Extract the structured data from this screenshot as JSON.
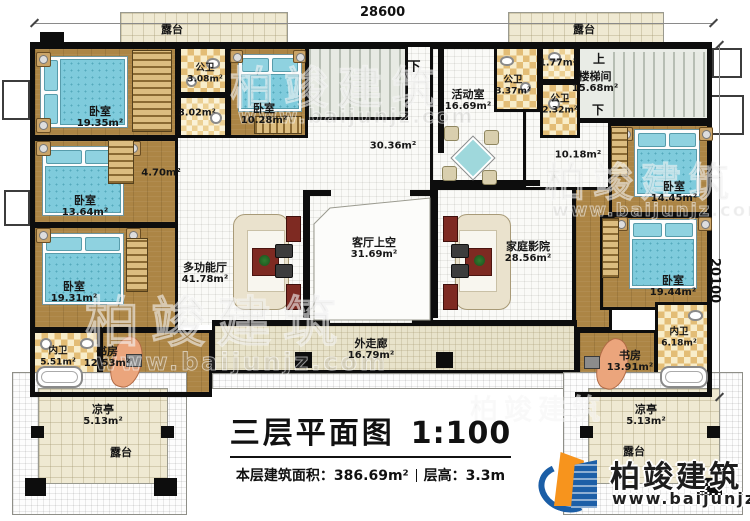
{
  "dimensions": {
    "top": "28600",
    "right": "20100"
  },
  "titleblock": {
    "title": "三层平面图",
    "scale": "1:100",
    "area_label": "本层建筑面积：",
    "area_value": "386.69m²",
    "floor_height_label": "层高：",
    "floor_height_value": "3.3m"
  },
  "logo": {
    "name": "柏竣建筑",
    "website": "www.baijunjz.com"
  },
  "watermark": {
    "brand": "柏竣建筑",
    "site": "www.baijunjz.com"
  },
  "rooms": {
    "terrace_top_left": {
      "label": "露台"
    },
    "terrace_top_right": {
      "label": "露台"
    },
    "bedroom_1935": {
      "label": "卧室",
      "area": "19.35m²"
    },
    "pubbath_308": {
      "label": "公卫",
      "area": "3.08m²"
    },
    "bath_302": {
      "area": "3.02m²"
    },
    "bedroom_1028": {
      "label": "卧室",
      "area": "10.28m²"
    },
    "hall_470": {
      "area": "4.70m²"
    },
    "stairs_down_mid": {
      "label": "下"
    },
    "hall_3036": {
      "area": "30.36m²"
    },
    "bedroom_1364": {
      "label": "卧室",
      "area": "13.64m²"
    },
    "bedroom_1931": {
      "label": "卧室",
      "area": "19.31m²"
    },
    "multi_hall": {
      "label": "多功能厅",
      "area": "41.78m²"
    },
    "living_void": {
      "label": "客厅上空",
      "area": "31.69m²"
    },
    "inner_bath_left": {
      "label": "内卫",
      "area": "5.51m²"
    },
    "study_left": {
      "label": "书房",
      "area": "12.53m²"
    },
    "pavilion_left": {
      "label": "凉亭",
      "area": "5.13m²"
    },
    "terrace_bottom_left": {
      "label": "露台"
    },
    "corridor": {
      "label": "外走廊",
      "area": "16.79m²"
    },
    "activity_room": {
      "label": "活动室",
      "area": "16.69m²"
    },
    "pubbath_337": {
      "label": "公卫",
      "area": "3.37m²"
    },
    "bath_177": {
      "area": "1.77m²"
    },
    "pubbath_232": {
      "label": "公卫",
      "area": "2.32m²"
    },
    "stair_up": {
      "label": "上"
    },
    "stairwell": {
      "label": "楼梯间",
      "area": "15.68m²"
    },
    "stair_down_right": {
      "label": "下"
    },
    "hall_1018": {
      "area": "10.18m²"
    },
    "home_theater": {
      "label": "家庭影院",
      "area": "28.56m²"
    },
    "bedroom_1445": {
      "label": "卧室",
      "area": "14.45m²"
    },
    "bedroom_1944": {
      "label": "卧室",
      "area": "19.44m²"
    },
    "inner_bath_right": {
      "label": "内卫",
      "area": "6.18m²"
    },
    "study_right": {
      "label": "书房",
      "area": "13.91m²"
    },
    "pavilion_right": {
      "label": "凉亭",
      "area": "5.13m²"
    },
    "terrace_bottom_right": {
      "label": "露台"
    }
  }
}
